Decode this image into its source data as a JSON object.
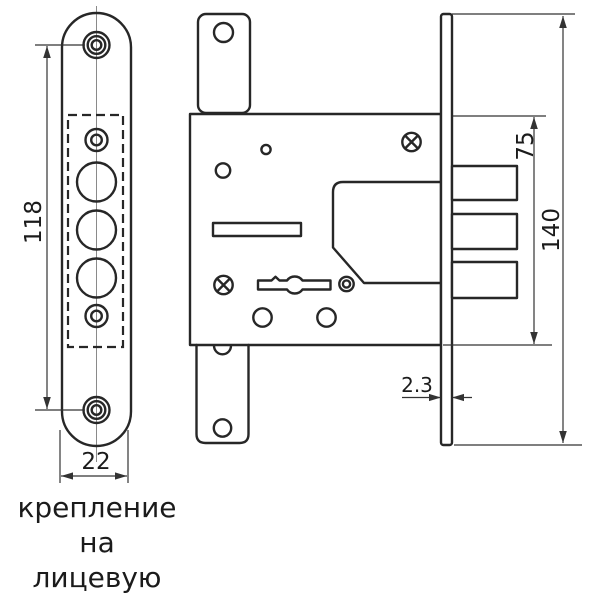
{
  "dimensions": {
    "hole_spacing": "118",
    "faceplate_width": "22",
    "body_height": "75",
    "plate_height": "140",
    "plate_thickness": "2.3"
  },
  "caption": {
    "line1": "крепление",
    "line2": "на лицевую",
    "line3": "планку"
  },
  "colors": {
    "outline": "#272727",
    "dimension": "#333333",
    "centerline": "#8a8a8a",
    "text": "#1b1b1b",
    "background": "#ffffff"
  }
}
